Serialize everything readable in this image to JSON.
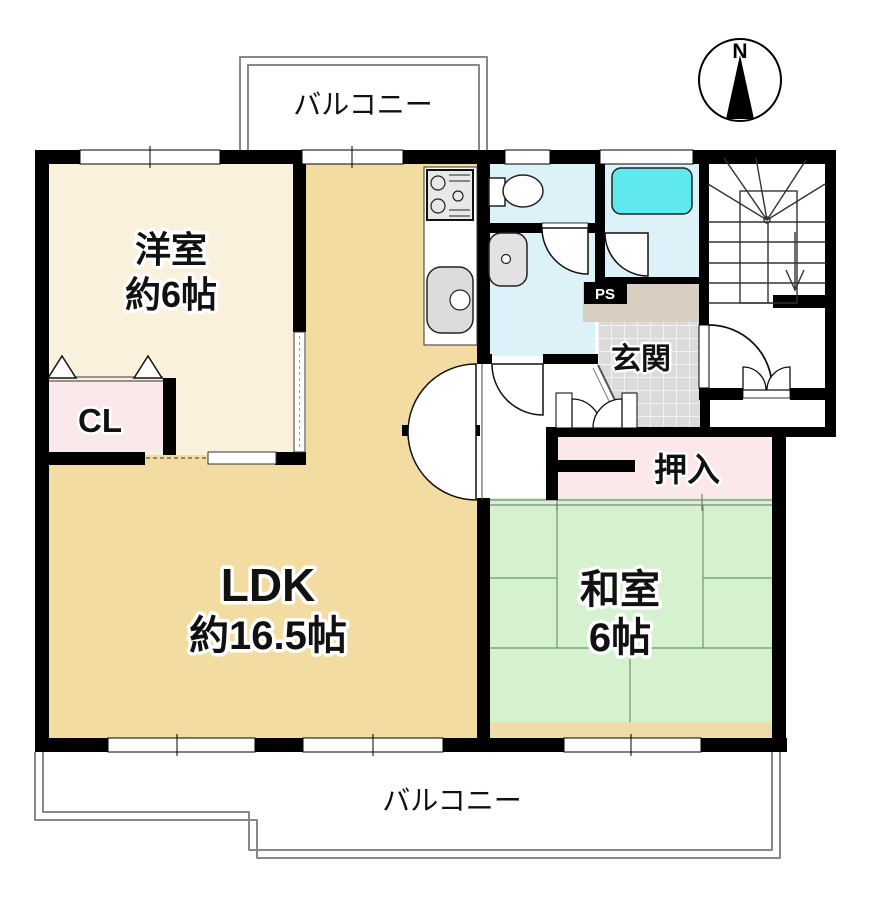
{
  "compass": {
    "north": "N"
  },
  "balconies": {
    "top": "バルコニー",
    "bottom": "バルコニー"
  },
  "rooms": {
    "western": {
      "name": "洋室",
      "size": "約6帖"
    },
    "cl": {
      "label": "CL"
    },
    "ldk": {
      "name": "LDK",
      "size": "約16.5帖"
    },
    "japanese": {
      "name": "和室",
      "size": "6帖"
    },
    "oshiire": {
      "label": "押入"
    },
    "genkan": {
      "label": "玄関"
    },
    "ps": {
      "label": "PS"
    }
  },
  "colors": {
    "wall": "#000000",
    "western": "#FAF1DC",
    "ldk": "#F3DCA2",
    "engawa": "#F0DCA8",
    "japanese": "#D6F1CF",
    "closet_pink": "#FBE8EA",
    "wet_blue": "#DCF2F8",
    "tub": "#5FE9EE",
    "tile": "#DBDBDB",
    "ps_beige": "#D8CEC2"
  }
}
